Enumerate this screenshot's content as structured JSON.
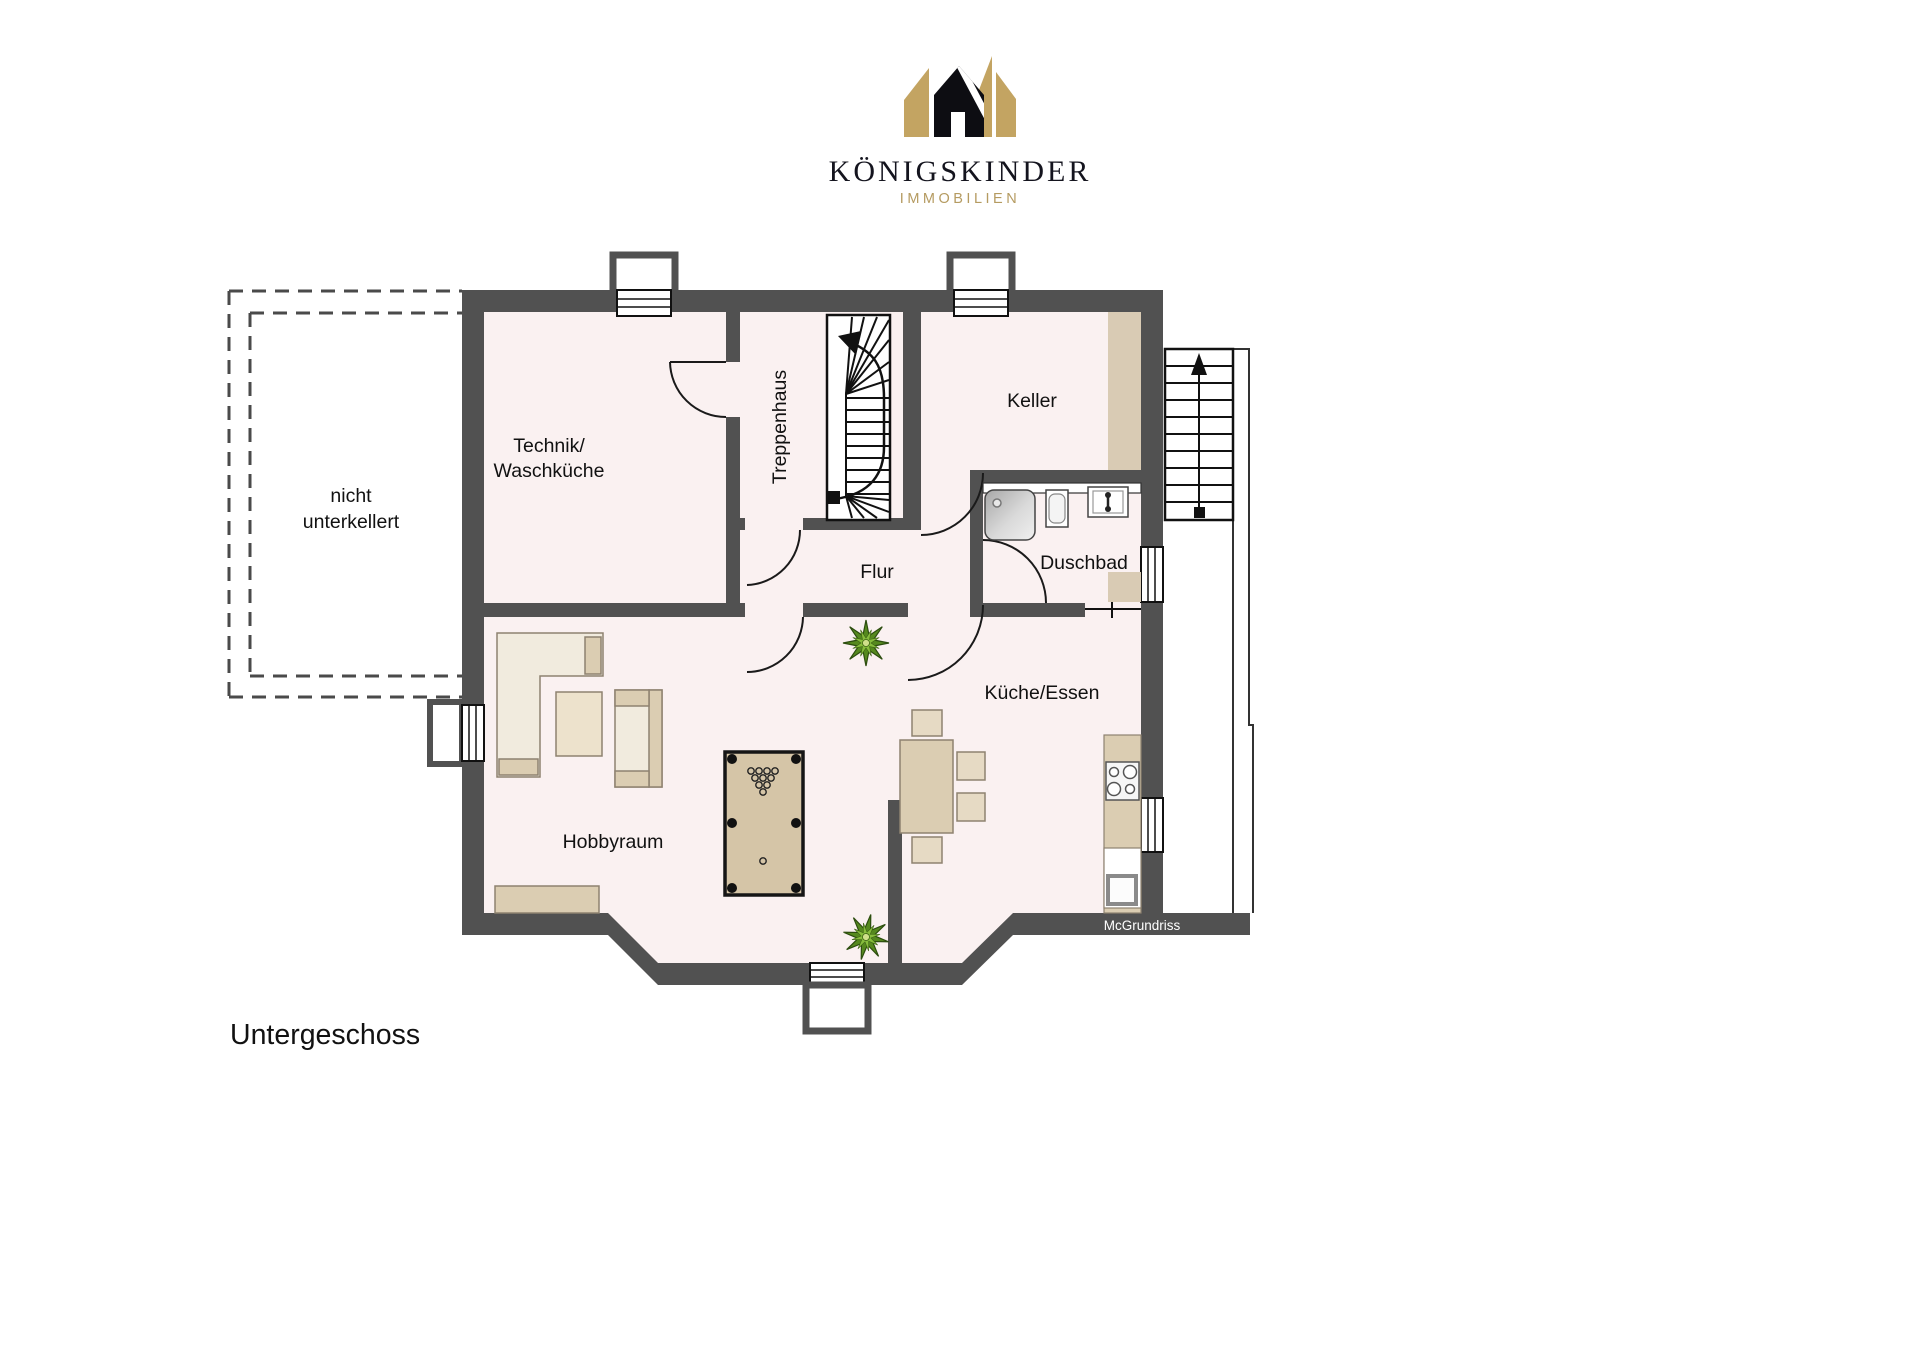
{
  "logo": {
    "brand": "KÖNIGSKINDER",
    "tagline": "IMMOBILIEN",
    "crown_icon": "crown-icon",
    "colors": {
      "gold": "#C3A462",
      "black": "#0D0D12"
    }
  },
  "plan": {
    "rooms": {
      "technik": {
        "line1": "Technik/",
        "line2": "Waschküche"
      },
      "treppenhaus": {
        "label": "Treppenhaus"
      },
      "keller": {
        "label": "Keller"
      },
      "duschbad": {
        "label": "Duschbad"
      },
      "flur": {
        "label": "Flur"
      },
      "kueche": {
        "label": "Küche/Essen"
      },
      "hobbyraum": {
        "label": "Hobbyraum"
      }
    },
    "basement_note": {
      "line1": "nicht",
      "line2": "unterkellert"
    },
    "watermark": "McGrundriss",
    "furniture": [
      "corner-sofa",
      "coffee-table",
      "sofa",
      "sideboard",
      "billiard-table",
      "dining-table",
      "chairs",
      "kitchen-counter",
      "stove",
      "kitchen-sink",
      "shower",
      "wc",
      "washbasin",
      "cellar-shelf",
      "plants",
      "interior-winder-stair",
      "exterior-stair"
    ],
    "colors": {
      "wall": "#515151",
      "floor": "#FAF1F1",
      "tan": "#DBCDB2",
      "tan_light": "#E6DAC4",
      "light": "#F1EBDE",
      "felt": "#D5C5A7",
      "shelf": "#D9CBB4",
      "plant_dark": "#55891E",
      "plant_light": "#86BD3C"
    }
  },
  "floor_label": "Untergeschoss"
}
